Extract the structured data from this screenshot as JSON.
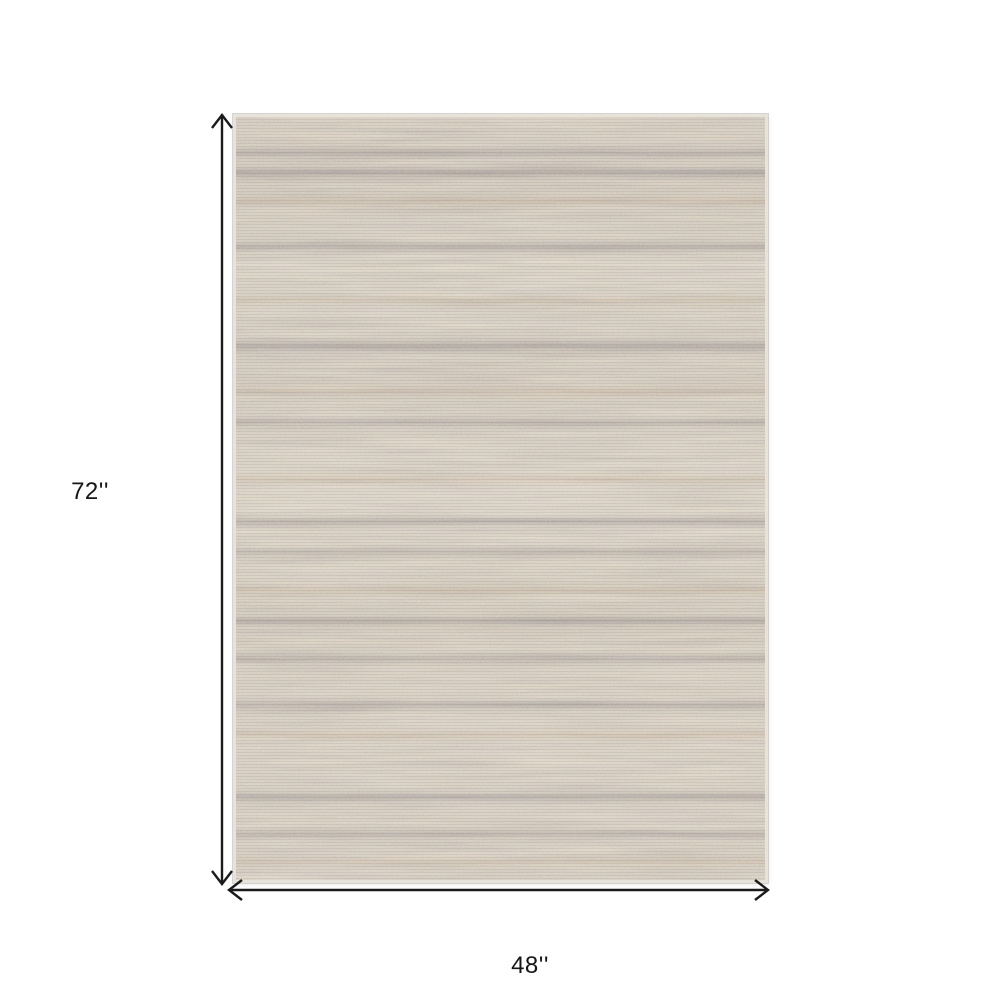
{
  "diagram": {
    "background_color": "#ffffff",
    "annotation_color": "#1b1b1b",
    "label_color": "#151515",
    "height_dimension": {
      "label": "72''",
      "orientation": "vertical"
    },
    "width_dimension": {
      "label": "48''",
      "orientation": "horizontal"
    },
    "rug": {
      "description": "Beige, tan and gray-lavender abstract striated area rug, horizontal variegated streaks",
      "base_color": "#e9e0d2",
      "streak_gray": "#8d8896",
      "streak_tan": "#c19b70",
      "off_white": "#ece8e0",
      "edge_color": "#e7e3db"
    }
  }
}
